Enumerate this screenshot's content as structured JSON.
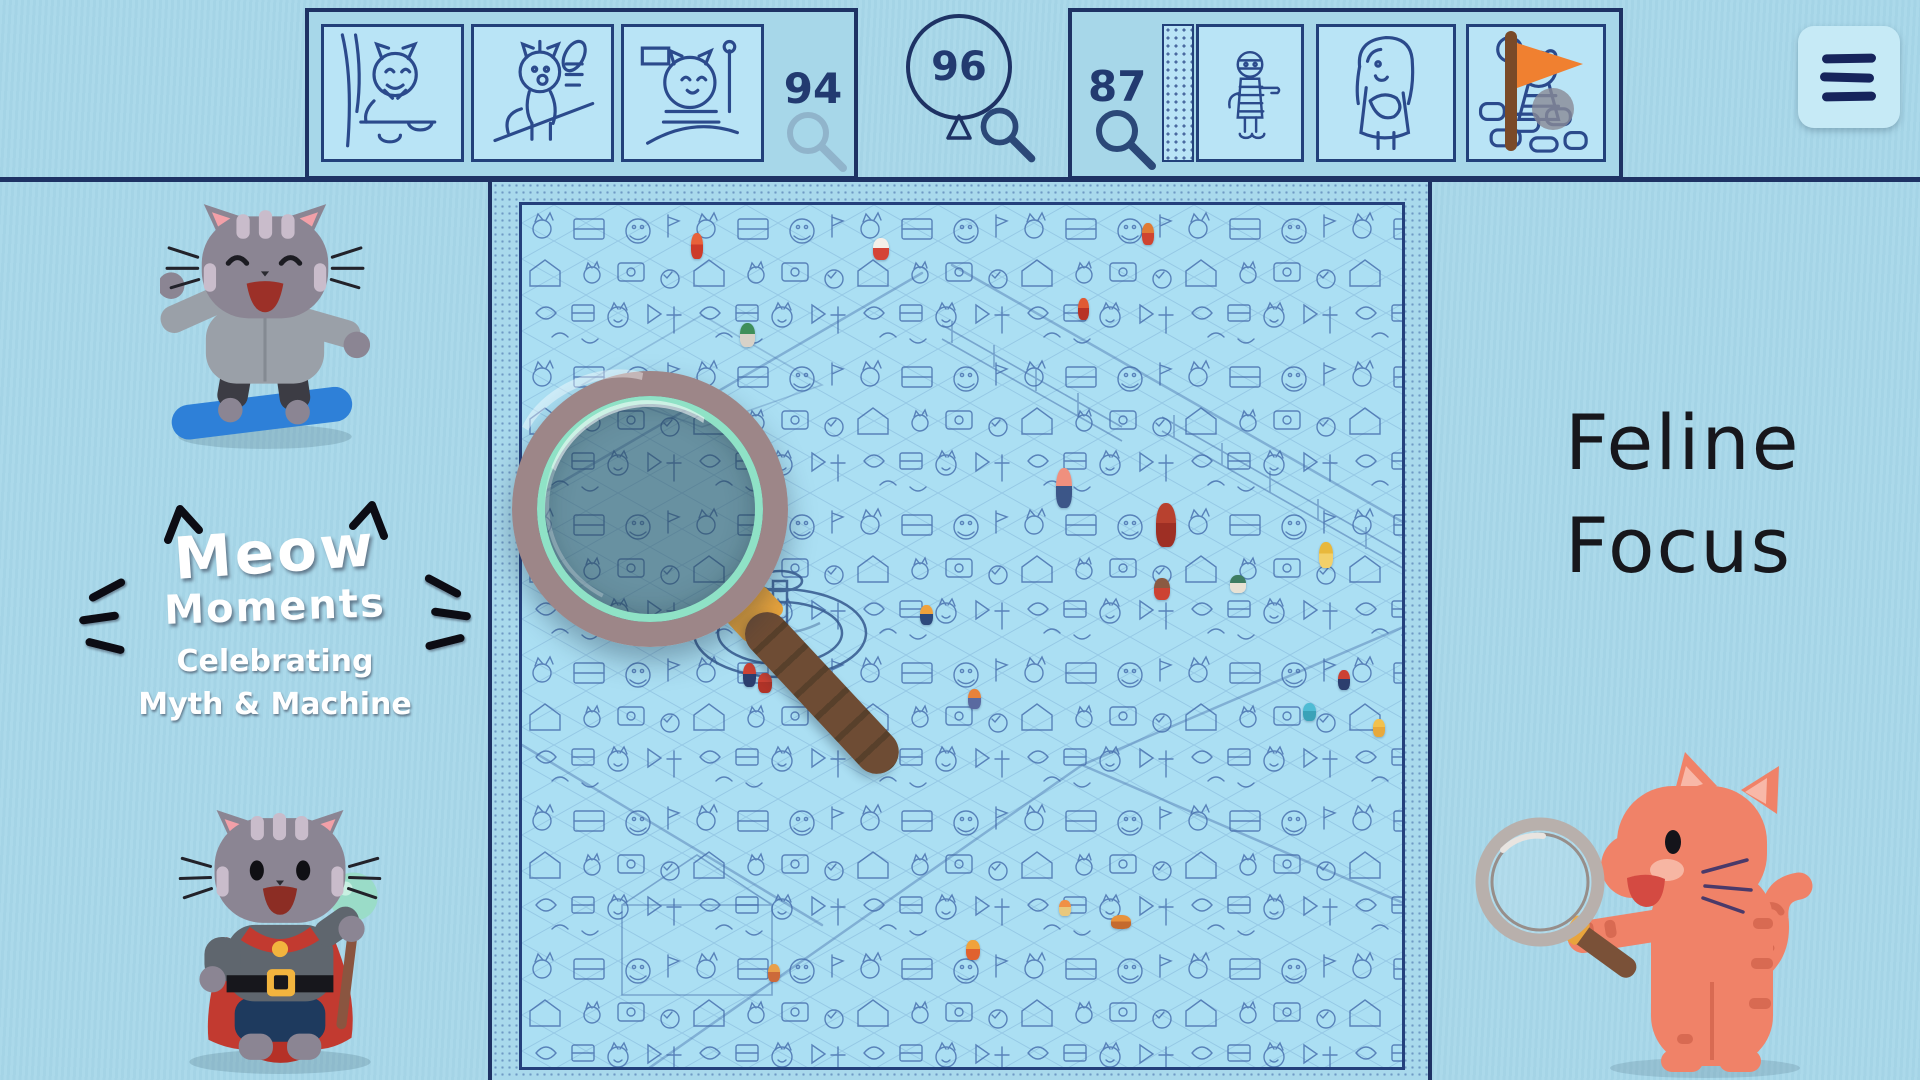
{
  "app": {
    "name": "Feline Focus hidden-object game"
  },
  "colors": {
    "background": "#a7d7e9",
    "line_navy": "#1e3264",
    "board_blue": "#abdff3",
    "mint_ring": "#8fe2c6",
    "rim_taupe": "#9d8688",
    "handle_brown": "#6e4c34",
    "gold_band": "#e9a43c",
    "cape_red": "#c23a30",
    "cat_gray": "#8b8593",
    "cat_orange": "#f08268"
  },
  "icons": {
    "menu": "hamburger-icon",
    "magnifier": "magnifying-glass-icon",
    "balloon": "balloon-counter-icon",
    "cat_ears": "cat-ear-icon",
    "whiskers": "whisker-icon"
  },
  "top_bar": {
    "left_panel": {
      "counter": "94",
      "magnifier_state": "faded",
      "thumbnails": [
        {
          "name": "cat-nibbling-at-table-thumbnail"
        },
        {
          "name": "startled-cat-on-table-thumbnail"
        },
        {
          "name": "chubby-cat-on-ride-thumbnail"
        }
      ]
    },
    "balloon": {
      "counter": "96"
    },
    "right_panel": {
      "counter": "87",
      "thumbnails": [
        {
          "name": "mummy-thumbnail"
        },
        {
          "name": "girl-hugging-satchel-thumbnail"
        },
        {
          "name": "bear-cub-with-balloon-thumbnail"
        }
      ]
    }
  },
  "branding": {
    "word1": "Meow",
    "word2": "Moments",
    "tagline1": "Celebrating",
    "tagline2": "Myth & Machine"
  },
  "title": {
    "line1": "Feline",
    "line2": "Focus"
  },
  "board": {
    "sprites": [
      {
        "name": "red-climbing-kid-sprite",
        "x": 169,
        "y": 28,
        "w": 12,
        "h": 26,
        "c1": "#e8623a",
        "c2": "#cc3b2a"
      },
      {
        "name": "red-climber-sprite",
        "x": 556,
        "y": 93,
        "w": 11,
        "h": 22,
        "c1": "#e05a34",
        "c2": "#b83226"
      },
      {
        "name": "white-cat-red-shirt-sprite",
        "x": 351,
        "y": 33,
        "w": 16,
        "h": 22,
        "c1": "#f5efe8",
        "c2": "#d44336"
      },
      {
        "name": "green-hat-cat-sprite",
        "x": 218,
        "y": 118,
        "w": 15,
        "h": 24,
        "c1": "#3f8f5a",
        "c2": "#d8d2c8"
      },
      {
        "name": "orange-vendor-sprite",
        "x": 620,
        "y": 18,
        "w": 12,
        "h": 22,
        "c1": "#e07b35",
        "c2": "#cf4430"
      },
      {
        "name": "pink-haired-woman-sprite",
        "x": 534,
        "y": 263,
        "w": 16,
        "h": 40,
        "c1": "#f0907e",
        "c2": "#3c5688"
      },
      {
        "name": "red-hooded-wizard-sprite",
        "x": 634,
        "y": 298,
        "w": 20,
        "h": 44,
        "c1": "#b8412f",
        "c2": "#9e2f24"
      },
      {
        "name": "red-caped-bear-sprite",
        "x": 632,
        "y": 373,
        "w": 16,
        "h": 22,
        "c1": "#8a5a42",
        "c2": "#cc4333"
      },
      {
        "name": "teal-turtle-sprite",
        "x": 708,
        "y": 370,
        "w": 16,
        "h": 18,
        "c1": "#3e7d62",
        "c2": "#e8e2d4"
      },
      {
        "name": "fountain-kid-sprite",
        "x": 398,
        "y": 400,
        "w": 13,
        "h": 20,
        "c1": "#f0a23c",
        "c2": "#2e4a7c"
      },
      {
        "name": "orange-haired-girl-sprite",
        "x": 446,
        "y": 484,
        "w": 13,
        "h": 20,
        "c1": "#e8823a",
        "c2": "#5a6aa0"
      },
      {
        "name": "boy-with-staff-sprite",
        "x": 221,
        "y": 458,
        "w": 13,
        "h": 24,
        "c1": "#cc4133",
        "c2": "#2c3e6e"
      },
      {
        "name": "kneeling-red-robe-sprite",
        "x": 236,
        "y": 468,
        "w": 14,
        "h": 20,
        "c1": "#cc4133",
        "c2": "#b03328"
      },
      {
        "name": "flame-witch-cat-sprite",
        "x": 444,
        "y": 735,
        "w": 14,
        "h": 20,
        "c1": "#f0a23c",
        "c2": "#e0622e"
      },
      {
        "name": "orange-kitten-sprite",
        "x": 537,
        "y": 695,
        "w": 12,
        "h": 16,
        "c1": "#f09046",
        "c2": "#e8c87c"
      },
      {
        "name": "yellow-cat-sprite",
        "x": 851,
        "y": 514,
        "w": 12,
        "h": 18,
        "c1": "#f2c14e",
        "c2": "#e8a93c"
      },
      {
        "name": "teal-mermaid-sprite",
        "x": 781,
        "y": 498,
        "w": 13,
        "h": 18,
        "c1": "#4fbcd4",
        "c2": "#3aa2b8"
      },
      {
        "name": "violinist-sprite",
        "x": 816,
        "y": 465,
        "w": 12,
        "h": 20,
        "c1": "#cc4133",
        "c2": "#2c3e6e"
      },
      {
        "name": "yellow-dress-woman-sprite",
        "x": 797,
        "y": 337,
        "w": 14,
        "h": 26,
        "c1": "#e8b83c",
        "c2": "#f2d06a"
      },
      {
        "name": "orange-wagon-sprite",
        "x": 589,
        "y": 710,
        "w": 20,
        "h": 14,
        "c1": "#e8923c",
        "c2": "#c46a2e"
      },
      {
        "name": "orange-walker-sprite",
        "x": 246,
        "y": 759,
        "w": 12,
        "h": 18,
        "c1": "#e8a04a",
        "c2": "#cc6a3a"
      }
    ]
  }
}
